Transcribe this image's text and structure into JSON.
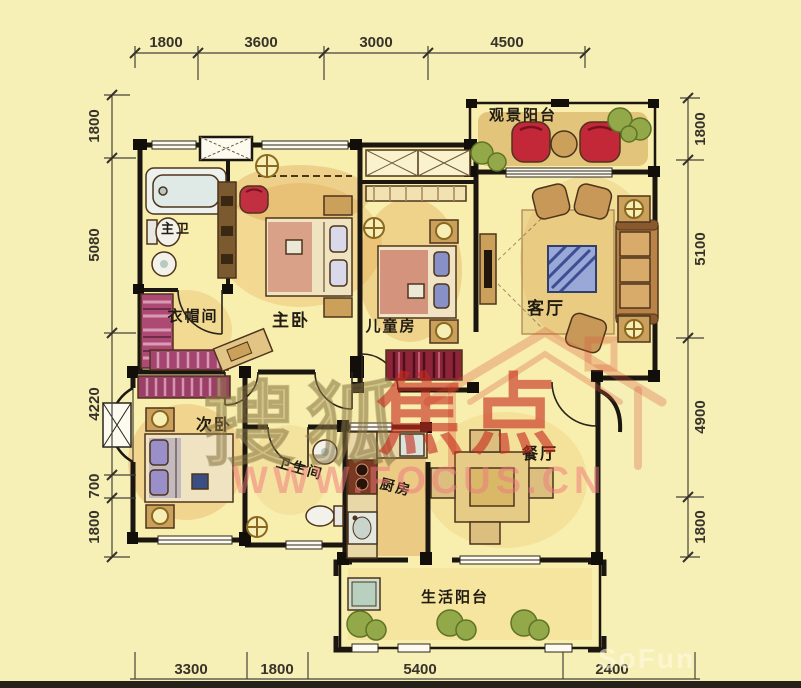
{
  "palette": {
    "background": "#f6efb6",
    "floor": "#f8eead",
    "wall": "#1b1610",
    "accent_red": "#c32838",
    "wardrobe_magenta": "#a84573",
    "plant_green": "#93a848",
    "watermark_tan": "rgba(158,138,82,0.45)",
    "watermark_red": "rgba(198,44,30,0.62)",
    "watermark_pink": "rgba(240,118,126,0.52)"
  },
  "rooms": {
    "master_bath": "主卫",
    "cloakroom": "衣帽间",
    "master_bedroom": "主卧",
    "kids_room": "儿童房",
    "view_balcony": "观景阳台",
    "living_room": "客厅",
    "second_bedroom": "次卧",
    "bathroom": "卫生间",
    "kitchen": "厨房",
    "dining_room": "餐厅",
    "service_balcony": "生活阳台"
  },
  "dimensions": {
    "top": [
      "1800",
      "3600",
      "3000",
      "4500"
    ],
    "left": [
      "1800",
      "5080",
      "4220",
      "700",
      "1800"
    ],
    "right": [
      "1800",
      "5100",
      "4900",
      "1800"
    ],
    "bottom": [
      "3300",
      "1800",
      "5400",
      "2400"
    ]
  },
  "watermark": {
    "brand": "搜狐",
    "logo": "焦点",
    "url": "WWW.FOCUS.CN",
    "ghost": "SoFun"
  }
}
